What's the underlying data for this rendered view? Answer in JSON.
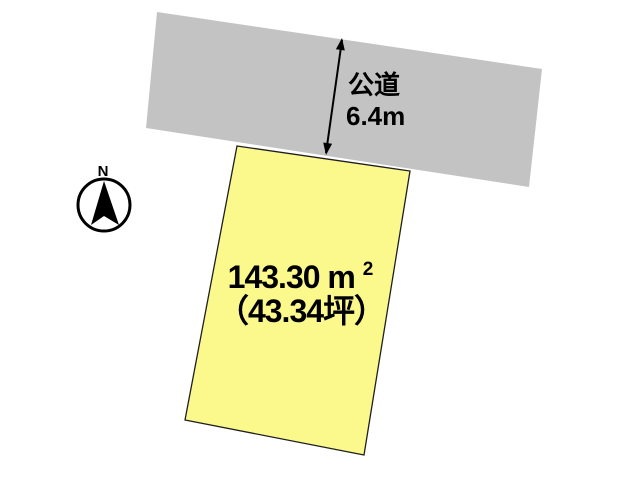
{
  "compass": {
    "north_label": "N"
  },
  "road": {
    "name_label": "公道",
    "width_label": "6.4m",
    "fill_color": "#c3c3c3"
  },
  "parcel": {
    "area_number": "143.30",
    "area_unit": "m",
    "area_unit_exponent": "2",
    "area_tsubo_label": "（43.34坪）",
    "fill_color": "#fbf98c",
    "outline_color": "#1f1f1f"
  },
  "colors": {
    "background": "#ffffff",
    "arrow": "#000000",
    "text": "#000000"
  }
}
